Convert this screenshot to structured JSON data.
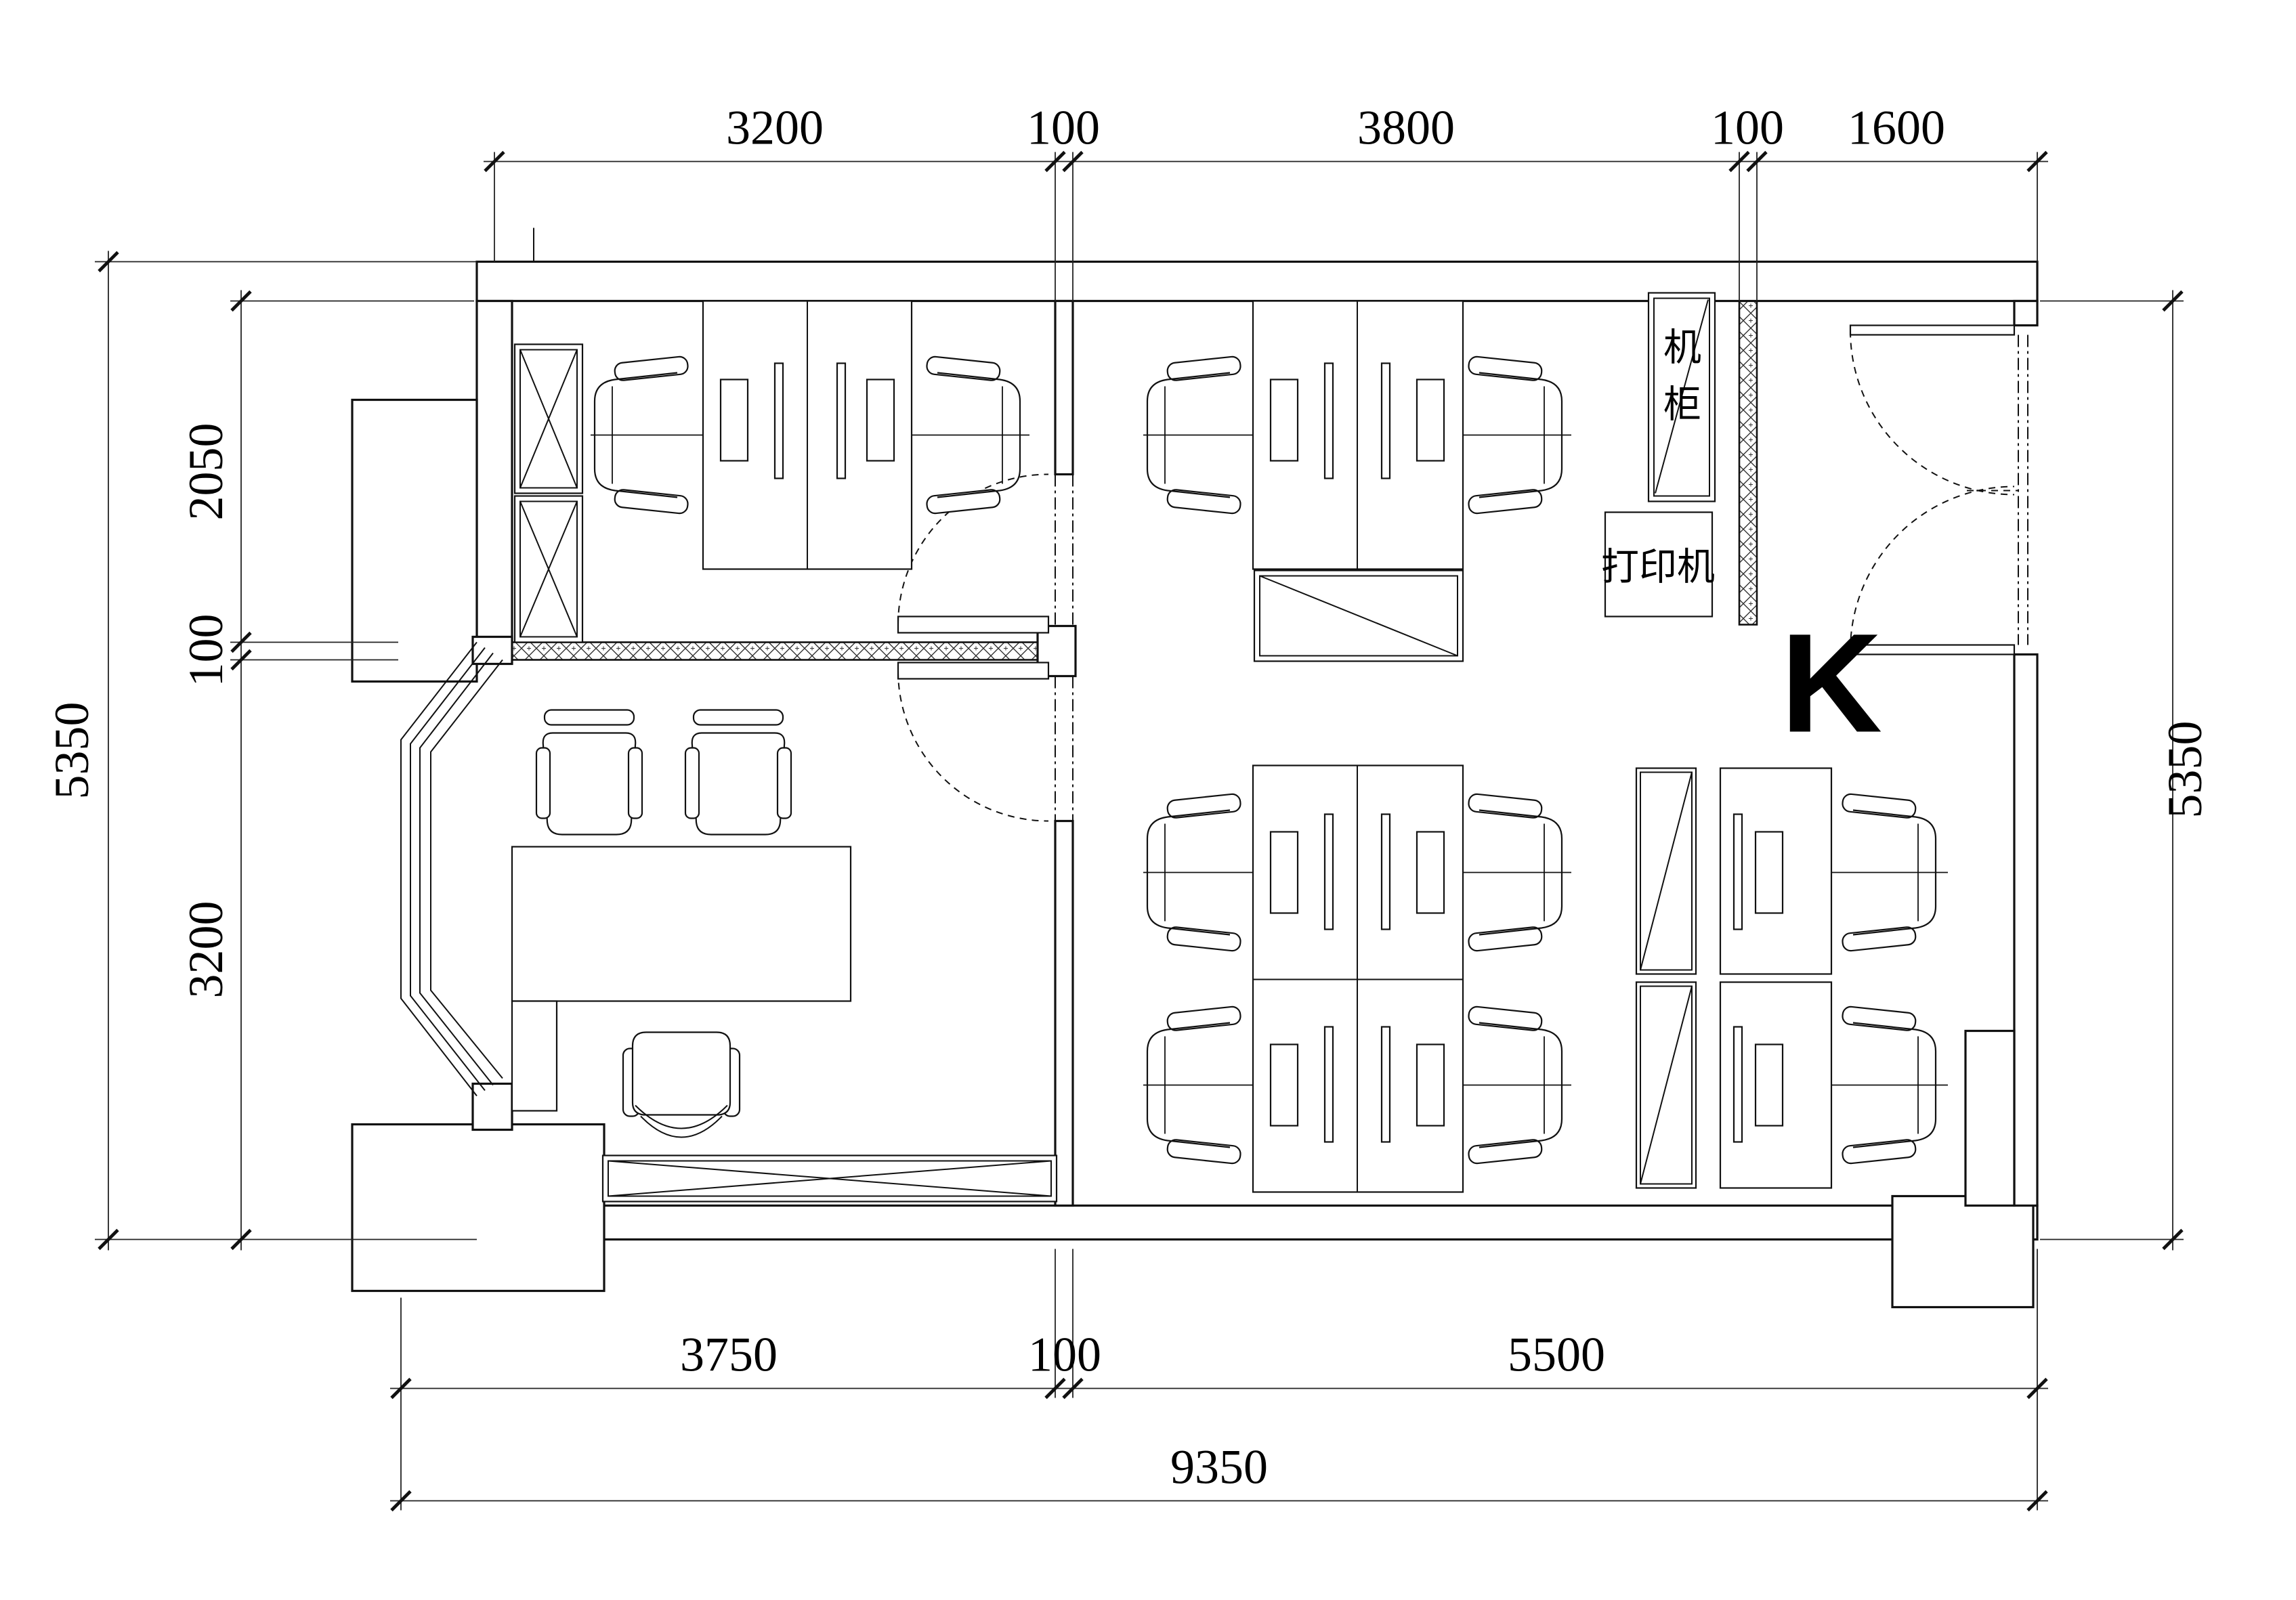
{
  "drawing": {
    "type": "architectural-floor-plan",
    "plan_letter": "K",
    "colors": {
      "line": "#111111",
      "background": "#ffffff"
    },
    "labels": {
      "server_cabinet": "机柜",
      "server_cabinet_chars": [
        "机",
        "柜"
      ],
      "printer": "打印机"
    },
    "dimensions": {
      "top": [
        "3200",
        "100",
        "3800",
        "100",
        "1600"
      ],
      "left_outer": "5350",
      "left_inner": [
        "2050",
        "100",
        "3200"
      ],
      "right": "5350",
      "bottom_inner": [
        "3750",
        "100",
        "5500"
      ],
      "bottom_outer": "9350"
    }
  }
}
